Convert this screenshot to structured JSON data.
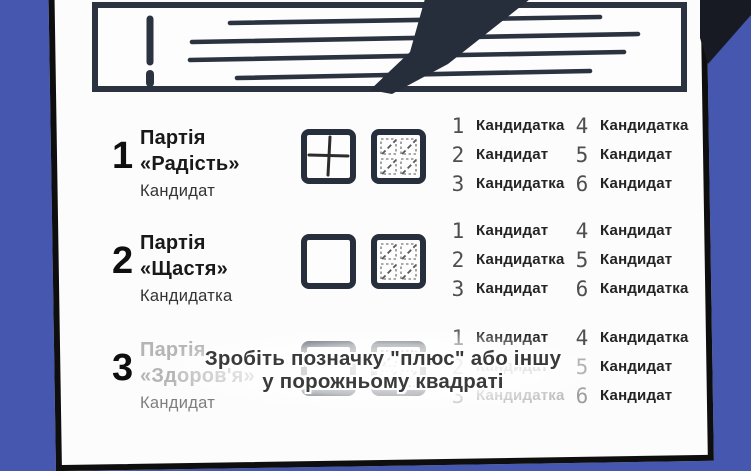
{
  "colors": {
    "background": "#4557ae",
    "ink": "#2b3240",
    "card": "#fcfcfc"
  },
  "icons": {
    "banner_warning": "exclamation-icon",
    "banner_pen": "pen-icon",
    "banner_text": "text-lines-icon",
    "mark_plus": "plus-mark-icon",
    "mark_pattern": "dotted-grid-icon"
  },
  "caption": {
    "line1": "Зробіть позначку \"плюс\" або іншу",
    "line2": "у порожньому квадраті"
  },
  "parties": [
    {
      "number": "1",
      "name1": "Партія",
      "name2": "«Радість»",
      "sub": "Кандидат",
      "box_left": "plus",
      "box_right": "pattern",
      "candidates": [
        {
          "num": "1",
          "label": "Кандидатка"
        },
        {
          "num": "2",
          "label": "Кандидат"
        },
        {
          "num": "3",
          "label": "Кандидатка"
        },
        {
          "num": "4",
          "label": "Кандидатка"
        },
        {
          "num": "5",
          "label": "Кандидат"
        },
        {
          "num": "6",
          "label": "Кандидат"
        }
      ]
    },
    {
      "number": "2",
      "name1": "Партія",
      "name2": "«Щастя»",
      "sub": "Кандидатка",
      "box_left": "empty",
      "box_right": "pattern",
      "candidates": [
        {
          "num": "1",
          "label": "Кандидат"
        },
        {
          "num": "2",
          "label": "Кандидатка"
        },
        {
          "num": "3",
          "label": "Кандидат"
        },
        {
          "num": "4",
          "label": "Кандидат"
        },
        {
          "num": "5",
          "label": "Кандидат"
        },
        {
          "num": "6",
          "label": "Кандидатка"
        }
      ]
    },
    {
      "number": "3",
      "name1": "Партія",
      "name2": "«Здоров'я»",
      "sub": "Кандидат",
      "box_left": "empty",
      "box_right": "pattern",
      "faded": true,
      "candidates": [
        {
          "num": "1",
          "label": "Кандидат"
        },
        {
          "num": "2",
          "label": "Кандидат"
        },
        {
          "num": "3",
          "label": "Кандидатка"
        },
        {
          "num": "4",
          "label": "Кандидатка"
        },
        {
          "num": "5",
          "label": "Кандидат"
        },
        {
          "num": "6",
          "label": "Кандидат"
        }
      ]
    }
  ]
}
